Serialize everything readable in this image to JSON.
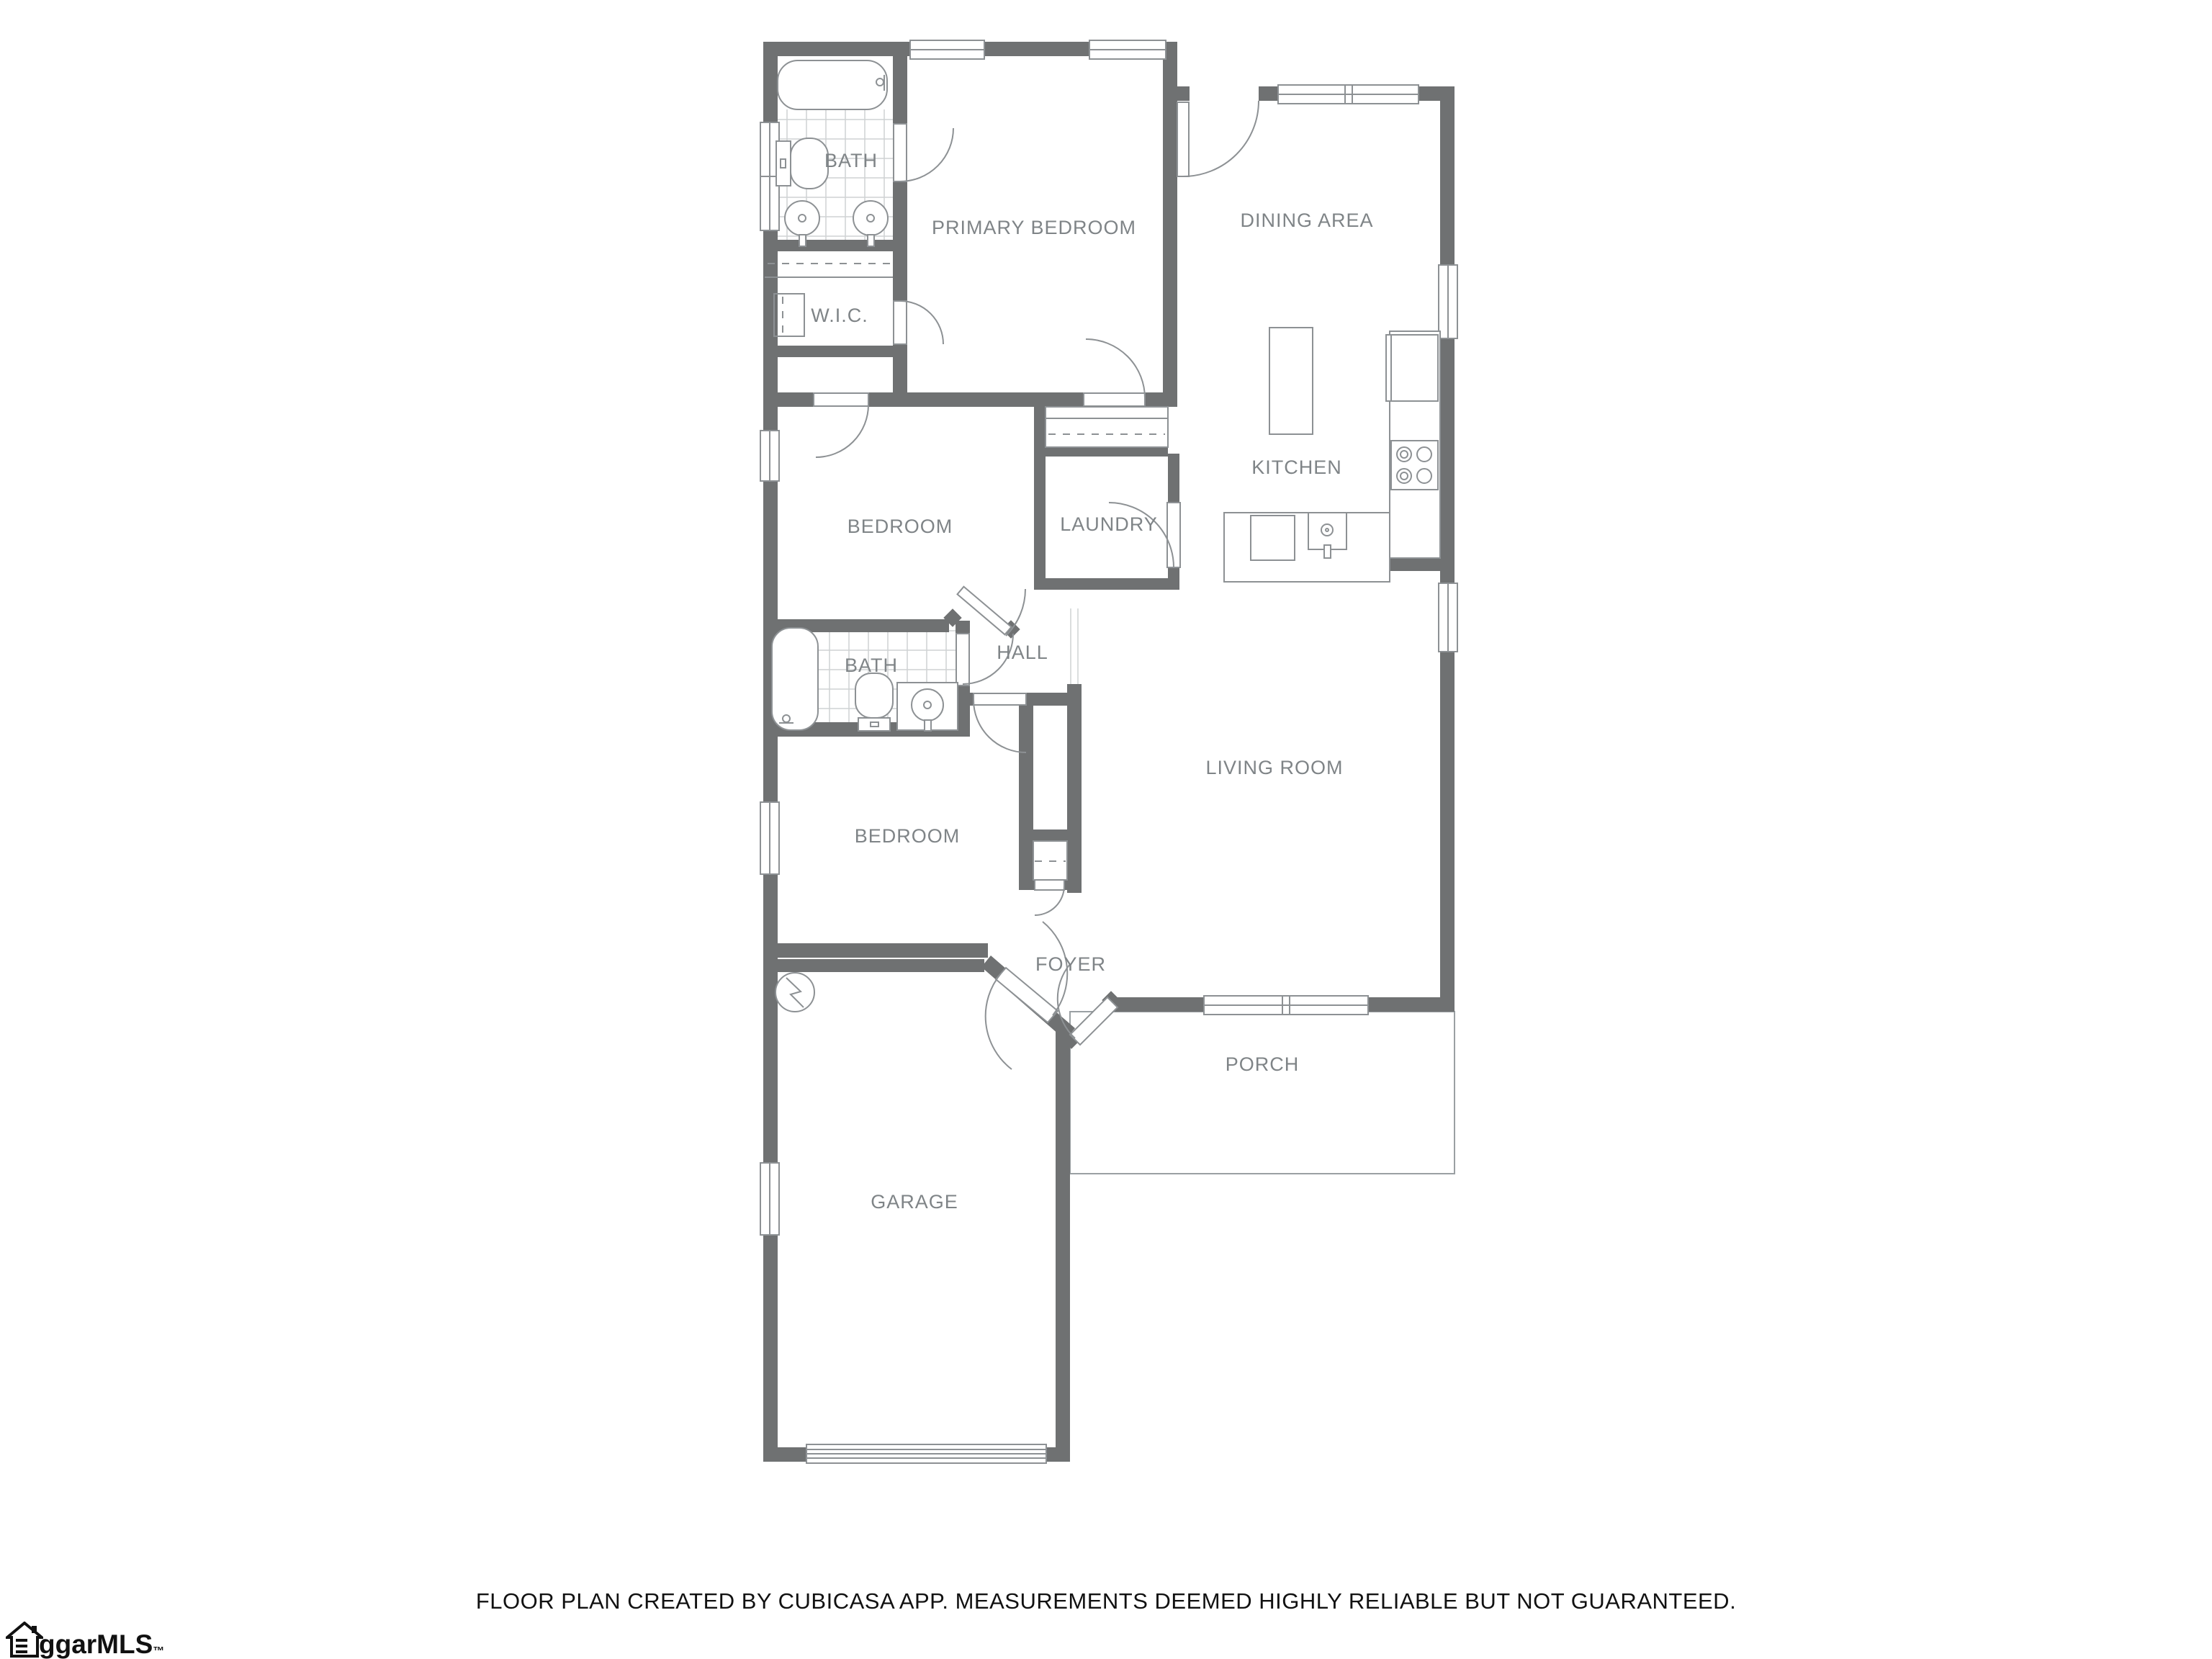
{
  "colors": {
    "wall": "#6f7172",
    "room_label": "#7f8487",
    "fixture_line": "#8d9194",
    "tile_line": "#cfd2d3",
    "porch_line": "#9aa0a3",
    "text": "#111111"
  },
  "rooms": {
    "bath1": {
      "label": "BATH"
    },
    "primary_bedroom": {
      "label": "PRIMARY BEDROOM"
    },
    "dining": {
      "label": "DINING AREA"
    },
    "wic": {
      "label": "W.I.C."
    },
    "bedroom2": {
      "label": "BEDROOM"
    },
    "laundry": {
      "label": "LAUNDRY"
    },
    "kitchen": {
      "label": "KITCHEN"
    },
    "hall": {
      "label": "HALL"
    },
    "bath2": {
      "label": "BATH"
    },
    "bedroom3": {
      "label": "BEDROOM"
    },
    "living": {
      "label": "LIVING ROOM"
    },
    "foyer": {
      "label": "FOYER"
    },
    "porch": {
      "label": "PORCH"
    },
    "garage": {
      "label": "GARAGE"
    }
  },
  "footer": {
    "disclaimer": "FLOOR PLAN CREATED BY CUBICASA APP. MEASUREMENTS DEEMED HIGHLY RELIABLE BUT NOT GUARANTEED."
  },
  "logo": {
    "icon": "house-icon",
    "text": "ggarMLS",
    "trademark": "™"
  }
}
